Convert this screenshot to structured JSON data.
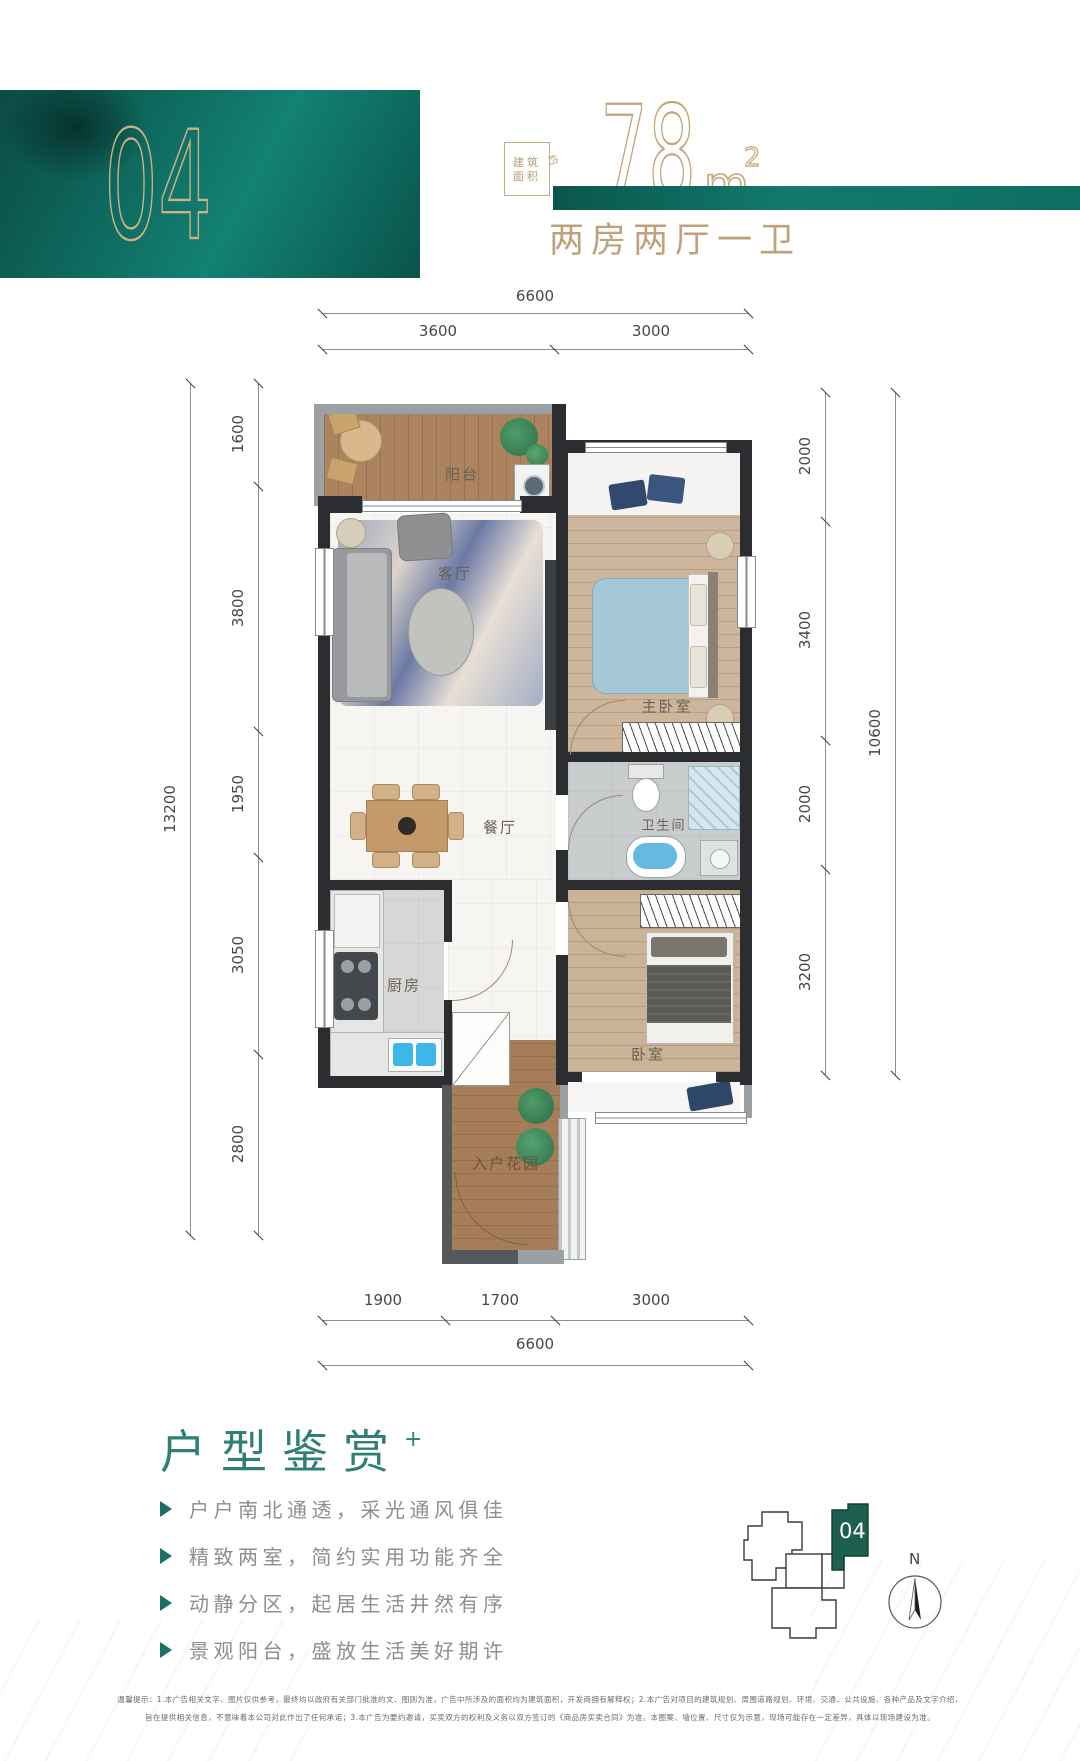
{
  "header": {
    "unit_number": "04",
    "area_box_line1": "建筑",
    "area_box_line2": "面积",
    "area_box_suffix": "约",
    "area_value": "78",
    "area_unit": "m",
    "area_exponent": "2",
    "layout_description": "两房两厅一卫"
  },
  "floorplan": {
    "rooms": [
      {
        "id": "balcony",
        "label": "阳台"
      },
      {
        "id": "living-room",
        "label": "客厅"
      },
      {
        "id": "master-bedroom",
        "label": "主卧室"
      },
      {
        "id": "dining-room",
        "label": "餐厅"
      },
      {
        "id": "bathroom",
        "label": "卫生间"
      },
      {
        "id": "kitchen",
        "label": "厨房"
      },
      {
        "id": "bedroom",
        "label": "卧室"
      },
      {
        "id": "entry-garden",
        "label": "入户花园"
      }
    ],
    "dimensions": {
      "top": {
        "total": "6600",
        "segments": [
          "3600",
          "3000"
        ]
      },
      "bottom": {
        "total": "6600",
        "segments": [
          "1900",
          "1700",
          "3000"
        ]
      },
      "left": {
        "total": "13200",
        "segments": [
          "1600",
          "3800",
          "1950",
          "3050",
          "2800"
        ]
      },
      "right": {
        "total": "10600",
        "segments": [
          "2000",
          "3400",
          "2000",
          "3200"
        ]
      }
    }
  },
  "features": {
    "title": "户型鉴赏",
    "title_mark": "+",
    "items": [
      "户户南北通透，采光通风俱佳",
      "精致两室，简约实用功能齐全",
      "动静分区，起居生活井然有序",
      "景观阳台，盛放生活美好期许"
    ]
  },
  "keyplan": {
    "unit_label": "04",
    "compass_label": "N"
  },
  "disclaimer": {
    "line1": "温馨提示：1.本广告相关文字、图片仅供参考，最终均以政府有关部门批准的文、图则为准，广告中所涉及的面积均为建筑面积，开发商拥有解释权；2.本广告对项目的建筑规划、周围道路规划、环境、交通、公共设施、各种产品及文字介绍，",
    "line2": "旨在提供相关信息，不意味着本公司对此作出了任何承诺；3.本广告为要约邀请，买卖双方的权利及义务以双方签订的《商品房买卖合同》为准。本图案、墙位置、尺寸仅为示意，现场可能存在一定差异，具体以现场建设为准。"
  },
  "colors": {
    "brand_teal": "#0e6e62",
    "gold": "#c0a179",
    "title_green": "#2d8073",
    "keyplan_green": "#1d5f50"
  }
}
